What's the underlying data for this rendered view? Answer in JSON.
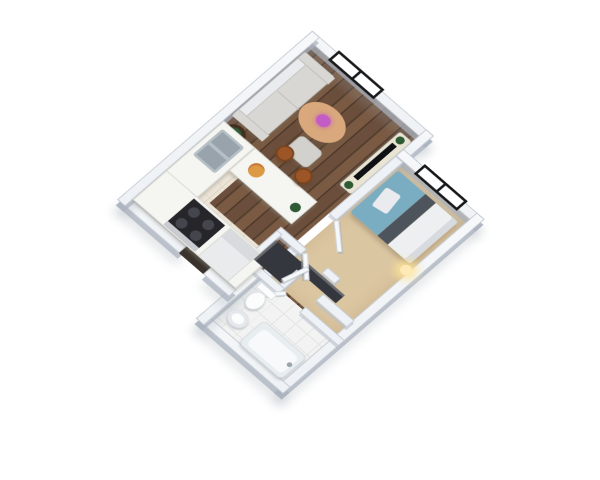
{
  "title": "3D apartment floor plan rendering",
  "view": "isometric-3d-floorplan",
  "colors": {
    "bg": "#ffffff",
    "wallTop": "#eef1f5",
    "wallOuter": "#f6f8fa",
    "wallEdge": "#c3c9d2",
    "wallShadow": "rgba(170,178,190,0.75)",
    "wallShadowLight": "rgba(185,192,202,0.6)",
    "wood1": "#6b4e3b",
    "wood2": "#55402f",
    "wood3": "#7a5a42",
    "wood4": "#4e392b",
    "carpet": "#dbc6a2",
    "tileBath": "#f2f3f2",
    "tileBathLine": "#e3e5e3",
    "tileKitchen": "#ece4d6",
    "tileKitchenLine": "#ddd3c2",
    "sofa": "#d8d7d3",
    "sofaEdge": "#bfbeba",
    "ottoman": "#d2d1cd",
    "tableWood": "#d9a87c",
    "flower": "#c45cc6",
    "planter": "#42301f",
    "plant": "#2e5a34",
    "counter": "#f5f5f2",
    "counterEdge": "#d8d8d2",
    "sink": "#b6bfc6",
    "sinkInner": "#98a3ac",
    "stove": "#26262a",
    "burner": "#45454d",
    "stoveFront": "#c8cbd0",
    "fridge": "#e9ebed",
    "stool": "#9c5526",
    "pizza": "#dd9a45",
    "bedTeal": "#7badc2",
    "bedBand": "#4e545c",
    "sheet": "#edeff1",
    "pillow": "#e9ebee",
    "console": "#eae5d3",
    "tv": "#101114",
    "clothes": "#34373d",
    "lampGlow": "#ffe9b4",
    "porcelain": "#fbfcfc",
    "porcelainEdge": "#d9dee2",
    "tubRim": "#e8edf0",
    "tubInner": "#f7f9fa",
    "doorLeaf": "#f7f8fa",
    "doorEdge": "#ccd2d9",
    "windowFrame": "#17181a",
    "windowPane": "#ffffff",
    "threshold": "#3a332c"
  },
  "scene": {
    "rooms": [
      {
        "name": "living-room",
        "floor": "dark-wood-planks",
        "contents": [
          "sofa",
          "coffee-table-with-flowers",
          "ottoman",
          "side-table-with-plant",
          "tv-console",
          "tv"
        ]
      },
      {
        "name": "kitchen",
        "floor": "beige-tile",
        "contents": [
          "l-shaped-counter",
          "double-sink",
          "stove-4-burners",
          "refrigerator",
          "breakfast-bar",
          "two-bar-stools",
          "pizza"
        ]
      },
      {
        "name": "bedroom",
        "floor": "beige-carpet",
        "contents": [
          "double-bed-teal",
          "pillow",
          "closet-with-clothes",
          "bedside-lamp"
        ]
      },
      {
        "name": "bathroom",
        "floor": "white-tile",
        "contents": [
          "toilet",
          "pedestal-sink",
          "bathtub"
        ]
      },
      {
        "name": "hallway",
        "floor": "dark-wood-planks",
        "contents": [
          "closet-with-clothes",
          "open-doors"
        ]
      }
    ],
    "windows": [
      {
        "name": "living-room-window",
        "wall": "north"
      },
      {
        "name": "bedroom-window",
        "wall": "north"
      }
    ],
    "doors": [
      "entry-door",
      "bedroom-door",
      "hallway-door",
      "closet-door",
      "bathroom-door"
    ]
  }
}
